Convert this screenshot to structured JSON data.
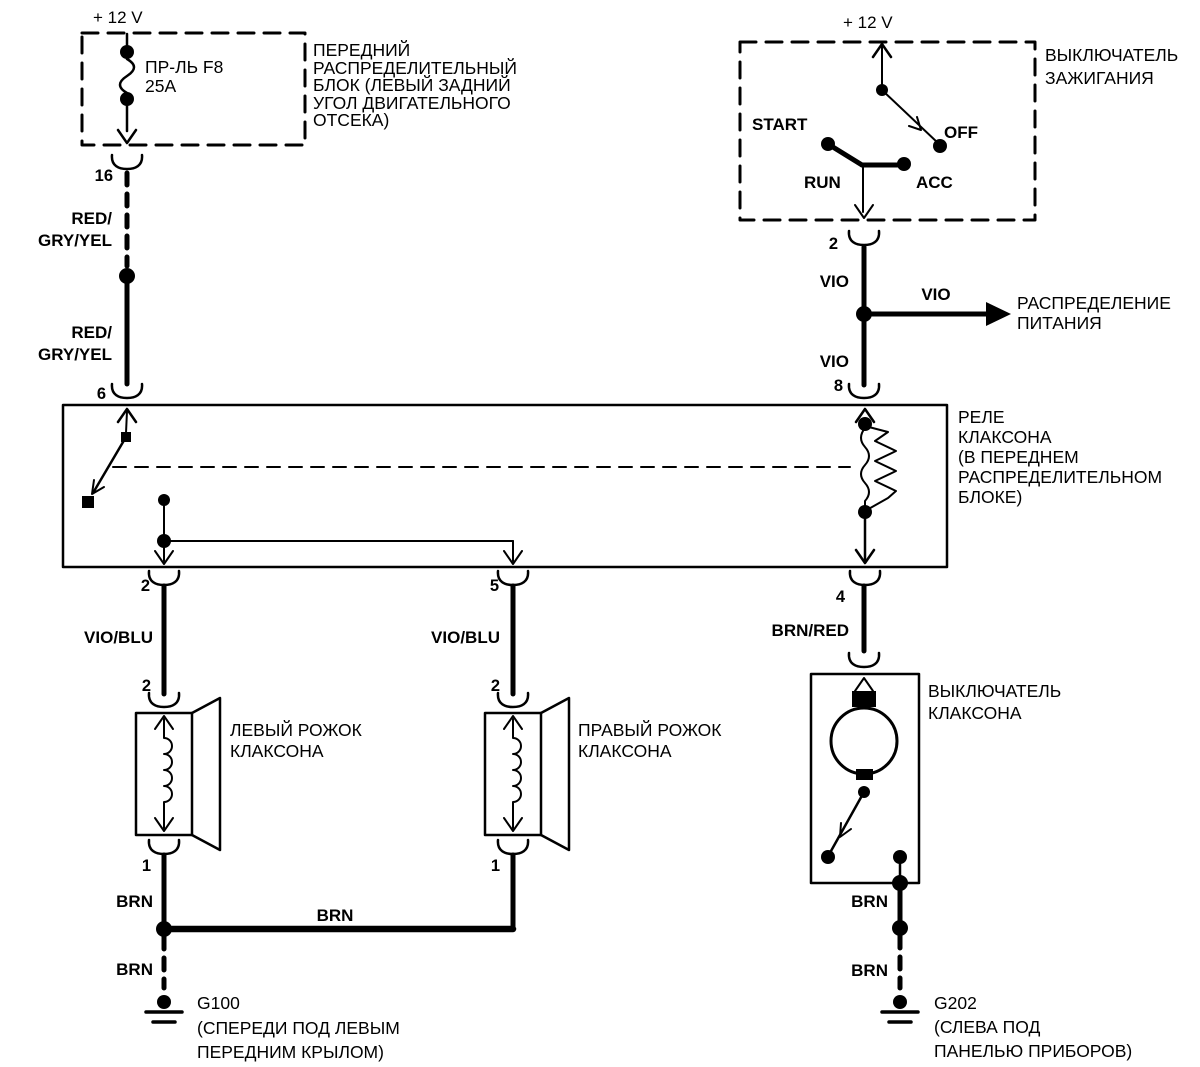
{
  "colors": {
    "ink": "#000000",
    "paper": "#ffffff"
  },
  "front_distribution_block": {
    "supply": "+ 12 V",
    "fuse_name": "ПР-ЛЬ F8",
    "fuse_rating": "25A",
    "label": [
      "ПЕРЕДНИЙ",
      "РАСПРЕДЕЛИТЕЛЬНЫЙ",
      "БЛОК (ЛЕВЫЙ ЗАДНИЙ",
      "УГОЛ ДВИГАТЕЛЬНОГО",
      "ОТСЕКА)"
    ],
    "out_pin": "16"
  },
  "ignition_switch": {
    "supply": "+ 12 V",
    "label": [
      "ВЫКЛЮЧАТЕЛЬ",
      "ЗАЖИГАНИЯ"
    ],
    "positions": {
      "start": "START",
      "off": "OFF",
      "run": "RUN",
      "acc": "ACC"
    },
    "out_pin": "2"
  },
  "power_distribution": {
    "wire": "VIO",
    "label": [
      "РАСПРЕДЕЛЕНИЕ",
      "ПИТАНИЯ"
    ]
  },
  "horn_relay": {
    "label": [
      "РЕЛЕ",
      "КЛАКСОНА",
      "(В ПЕРЕДНЕМ",
      "РАСПРЕДЕЛИТЕЛЬНОМ",
      "БЛОКЕ)"
    ],
    "pin_in_left": "6",
    "pin_in_right": "8",
    "pin_out_left_horn": "2",
    "pin_out_right_horn": "5",
    "pin_out_switch": "4"
  },
  "wires": {
    "feed_upper": [
      "RED/",
      "GRY/YEL"
    ],
    "feed_lower": [
      "RED/",
      "GRY/YEL"
    ],
    "ignition_upper": "VIO",
    "ignition_lower": "VIO",
    "left_horn_feed": "VIO/BLU",
    "right_horn_feed": "VIO/BLU",
    "switch_feed": "BRN/RED",
    "left_horn_ground": "BRN",
    "horn_link": "BRN",
    "left_ground_tail": "BRN",
    "switch_ground": "BRN",
    "right_ground_tail": "BRN"
  },
  "left_horn": {
    "pin_in": "2",
    "pin_out": "1",
    "label": [
      "ЛЕВЫЙ РОЖОК",
      "КЛАКСОНА"
    ]
  },
  "right_horn": {
    "pin_in": "2",
    "pin_out": "1",
    "label": [
      "ПРАВЫЙ РОЖОК",
      "КЛАКСОНА"
    ]
  },
  "horn_switch": {
    "label": [
      "ВЫКЛЮЧАТЕЛЬ",
      "КЛАКСОНА"
    ]
  },
  "ground_left": {
    "name": "G100",
    "label": [
      "(СПЕРЕДИ ПОД ЛЕВЫМ",
      "ПЕРЕДНИМ КРЫЛОМ)"
    ]
  },
  "ground_right": {
    "name": "G202",
    "label": [
      "(СЛЕВА ПОД",
      "ПАНЕЛЬЮ ПРИБОРОВ)"
    ]
  }
}
